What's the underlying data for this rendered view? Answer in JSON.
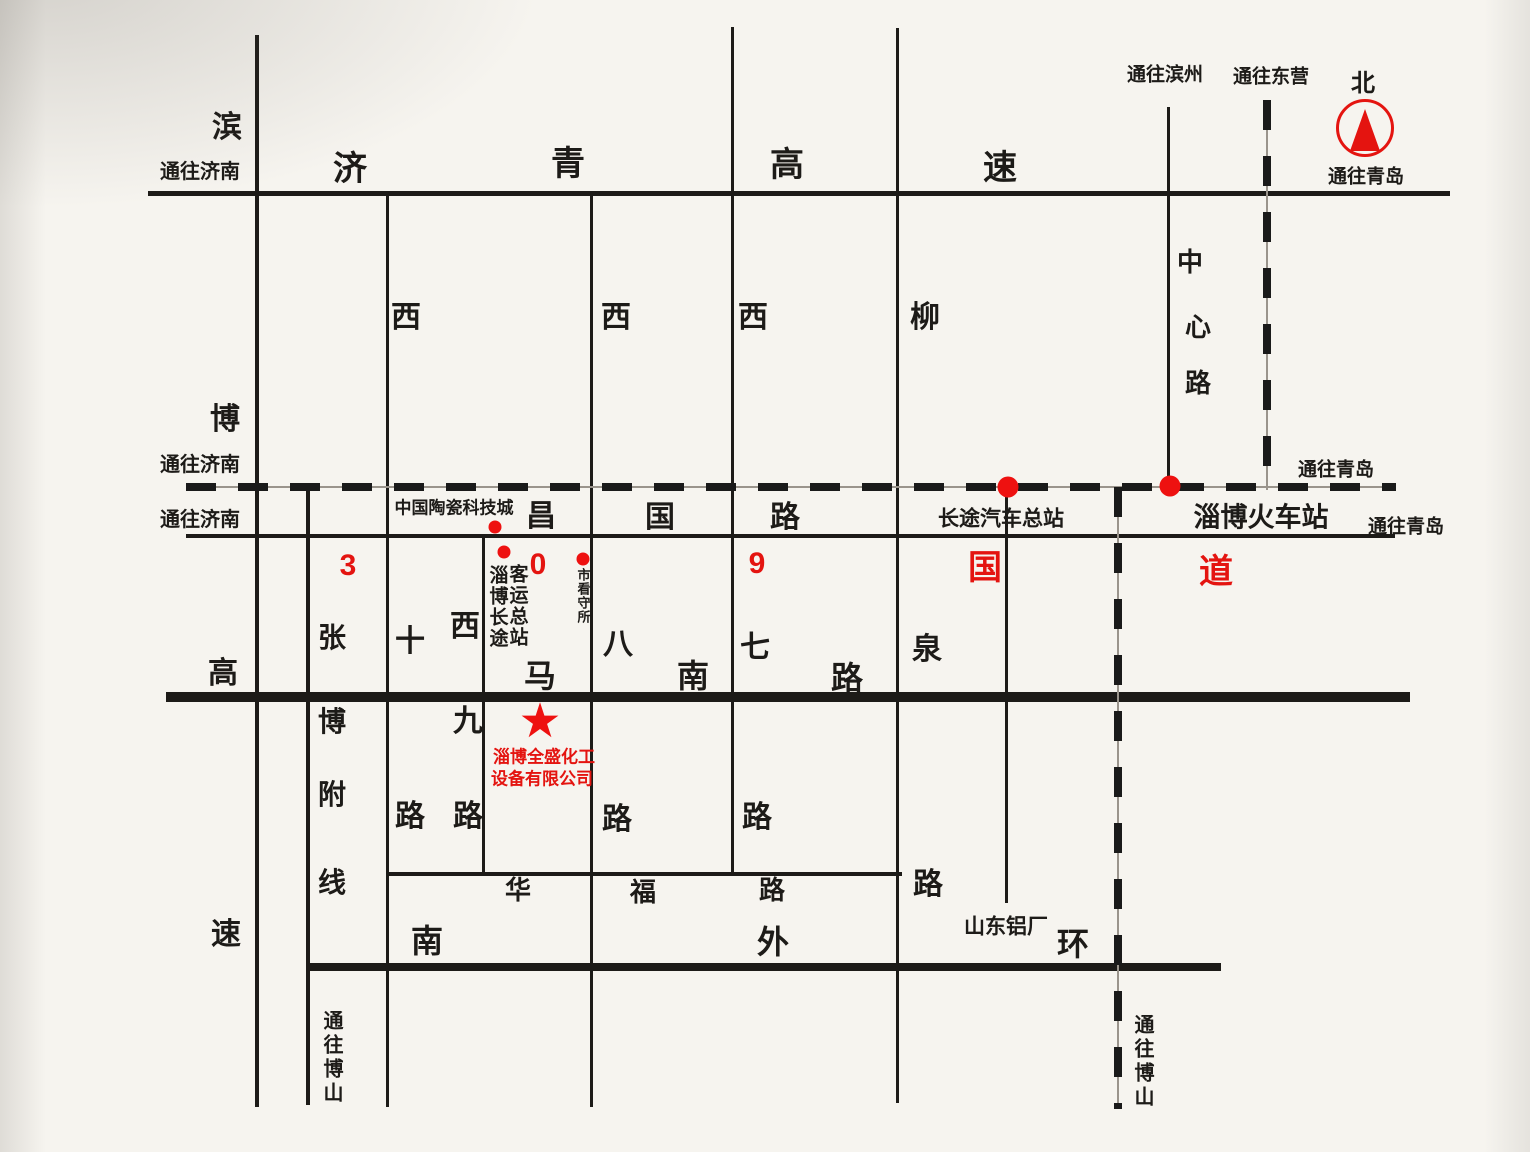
{
  "canvas": {
    "width": 1530,
    "height": 1152,
    "background": "#f6f4ef"
  },
  "colors": {
    "ink": "#1d1b18",
    "accent_red": "#e41410"
  },
  "compass": {
    "north": "北"
  },
  "directions": {
    "to_jinan": "通往济南",
    "to_qingdao": "通往青岛",
    "to_binzhou": "通往滨州",
    "to_dongying": "通往东营",
    "to_boshan": "通往博山"
  },
  "highways": {
    "jiqing": {
      "name": "济青高速",
      "chars": [
        "济",
        "青",
        "高",
        "速"
      ]
    },
    "binbo": {
      "name": "滨博高速",
      "chars": [
        "滨",
        "博",
        "高",
        "速"
      ]
    }
  },
  "streets": {
    "changguo": {
      "name": "昌国路",
      "chars": [
        "昌",
        "国",
        "路"
      ]
    },
    "route309": {
      "name": "309国道",
      "chars": [
        "3",
        "0",
        "9",
        "国",
        "道"
      ]
    },
    "manan": {
      "name": "马南路",
      "chars": [
        "马",
        "南",
        "路"
      ]
    },
    "huafu": {
      "name": "华福路",
      "chars": [
        "华",
        "福",
        "路"
      ]
    },
    "nan_waihuan": {
      "name": "南外环",
      "chars": [
        "南",
        "外",
        "环"
      ]
    },
    "zhangbo_fuxian": {
      "name": "张博附线",
      "chars": [
        "张",
        "博",
        "附",
        "线"
      ]
    },
    "xi_shi": {
      "name": "西十路",
      "chars": [
        "西",
        "十",
        "路"
      ]
    },
    "xi_jiu": {
      "name": "西九路",
      "chars": [
        "西",
        "九",
        "路"
      ]
    },
    "xi_ba": {
      "name": "西八路",
      "chars": [
        "西",
        "八",
        "路"
      ]
    },
    "xi_qi": {
      "name": "西七路",
      "chars": [
        "西",
        "七",
        "路"
      ]
    },
    "liuquan": {
      "name": "柳泉路",
      "chars": [
        "柳",
        "泉",
        "路"
      ]
    },
    "zhongxin": {
      "name": "中心路",
      "chars": [
        "中",
        "心",
        "路"
      ]
    }
  },
  "pois": {
    "ceramic_city": "中国陶瓷科技城",
    "bus_terminal_col_left": "淄博长途",
    "bus_terminal_col_right": "客运总站",
    "detention_house": "市看守所",
    "bus_station": "长途汽车总站",
    "train_station": "淄博火车站",
    "aluminum_plant": "山东铝厂",
    "company": {
      "marker": "★",
      "line1": "淄博全盛化工",
      "line2": "设备有限公司"
    }
  }
}
